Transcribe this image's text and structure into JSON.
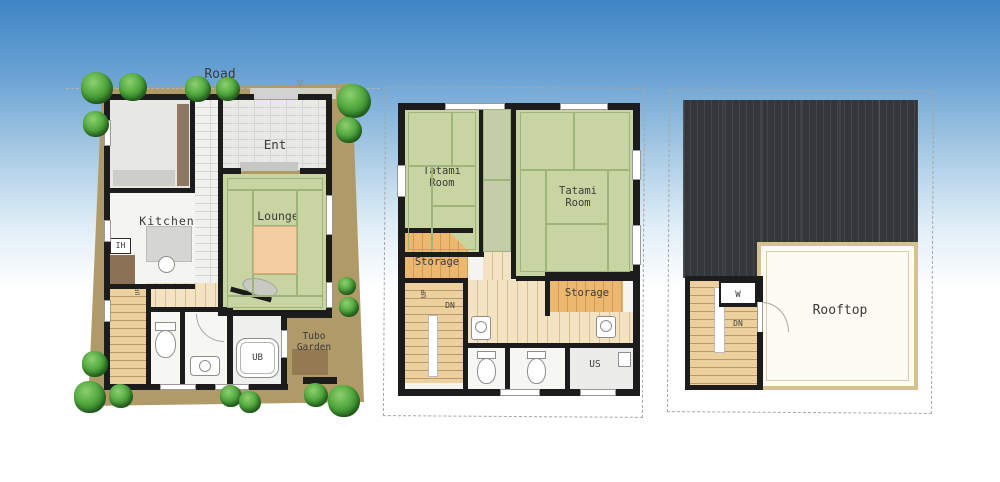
{
  "title": "Three storey house floor plans",
  "plan1": {
    "road": "Road",
    "ent": "Ent",
    "kitchen": "Kitchen",
    "ih": "IH",
    "lounge": "Lounge",
    "up": "UP",
    "ub": "UB",
    "tubo_garden": "Tubo\nGarden"
  },
  "plan2": {
    "tatami_left": "Tatami\nRoom",
    "tatami_right": "Tatami\nRoom",
    "storage_left": "Storage",
    "storage_right": "Storage",
    "up": "UP",
    "dn": "DN",
    "us": "US"
  },
  "plan3": {
    "w": "W",
    "dn": "DN",
    "rooftop": "Rooftop"
  },
  "colors": {
    "sky1": "#3e85c4",
    "lot": "#b09a68",
    "wall": "#1c1c1c",
    "tatami": "#c8d5a2",
    "roof": "#33363b",
    "terrace": "#fdfbf3",
    "storage_wood": "#ecb76f",
    "tree_green": "#55ab41"
  }
}
